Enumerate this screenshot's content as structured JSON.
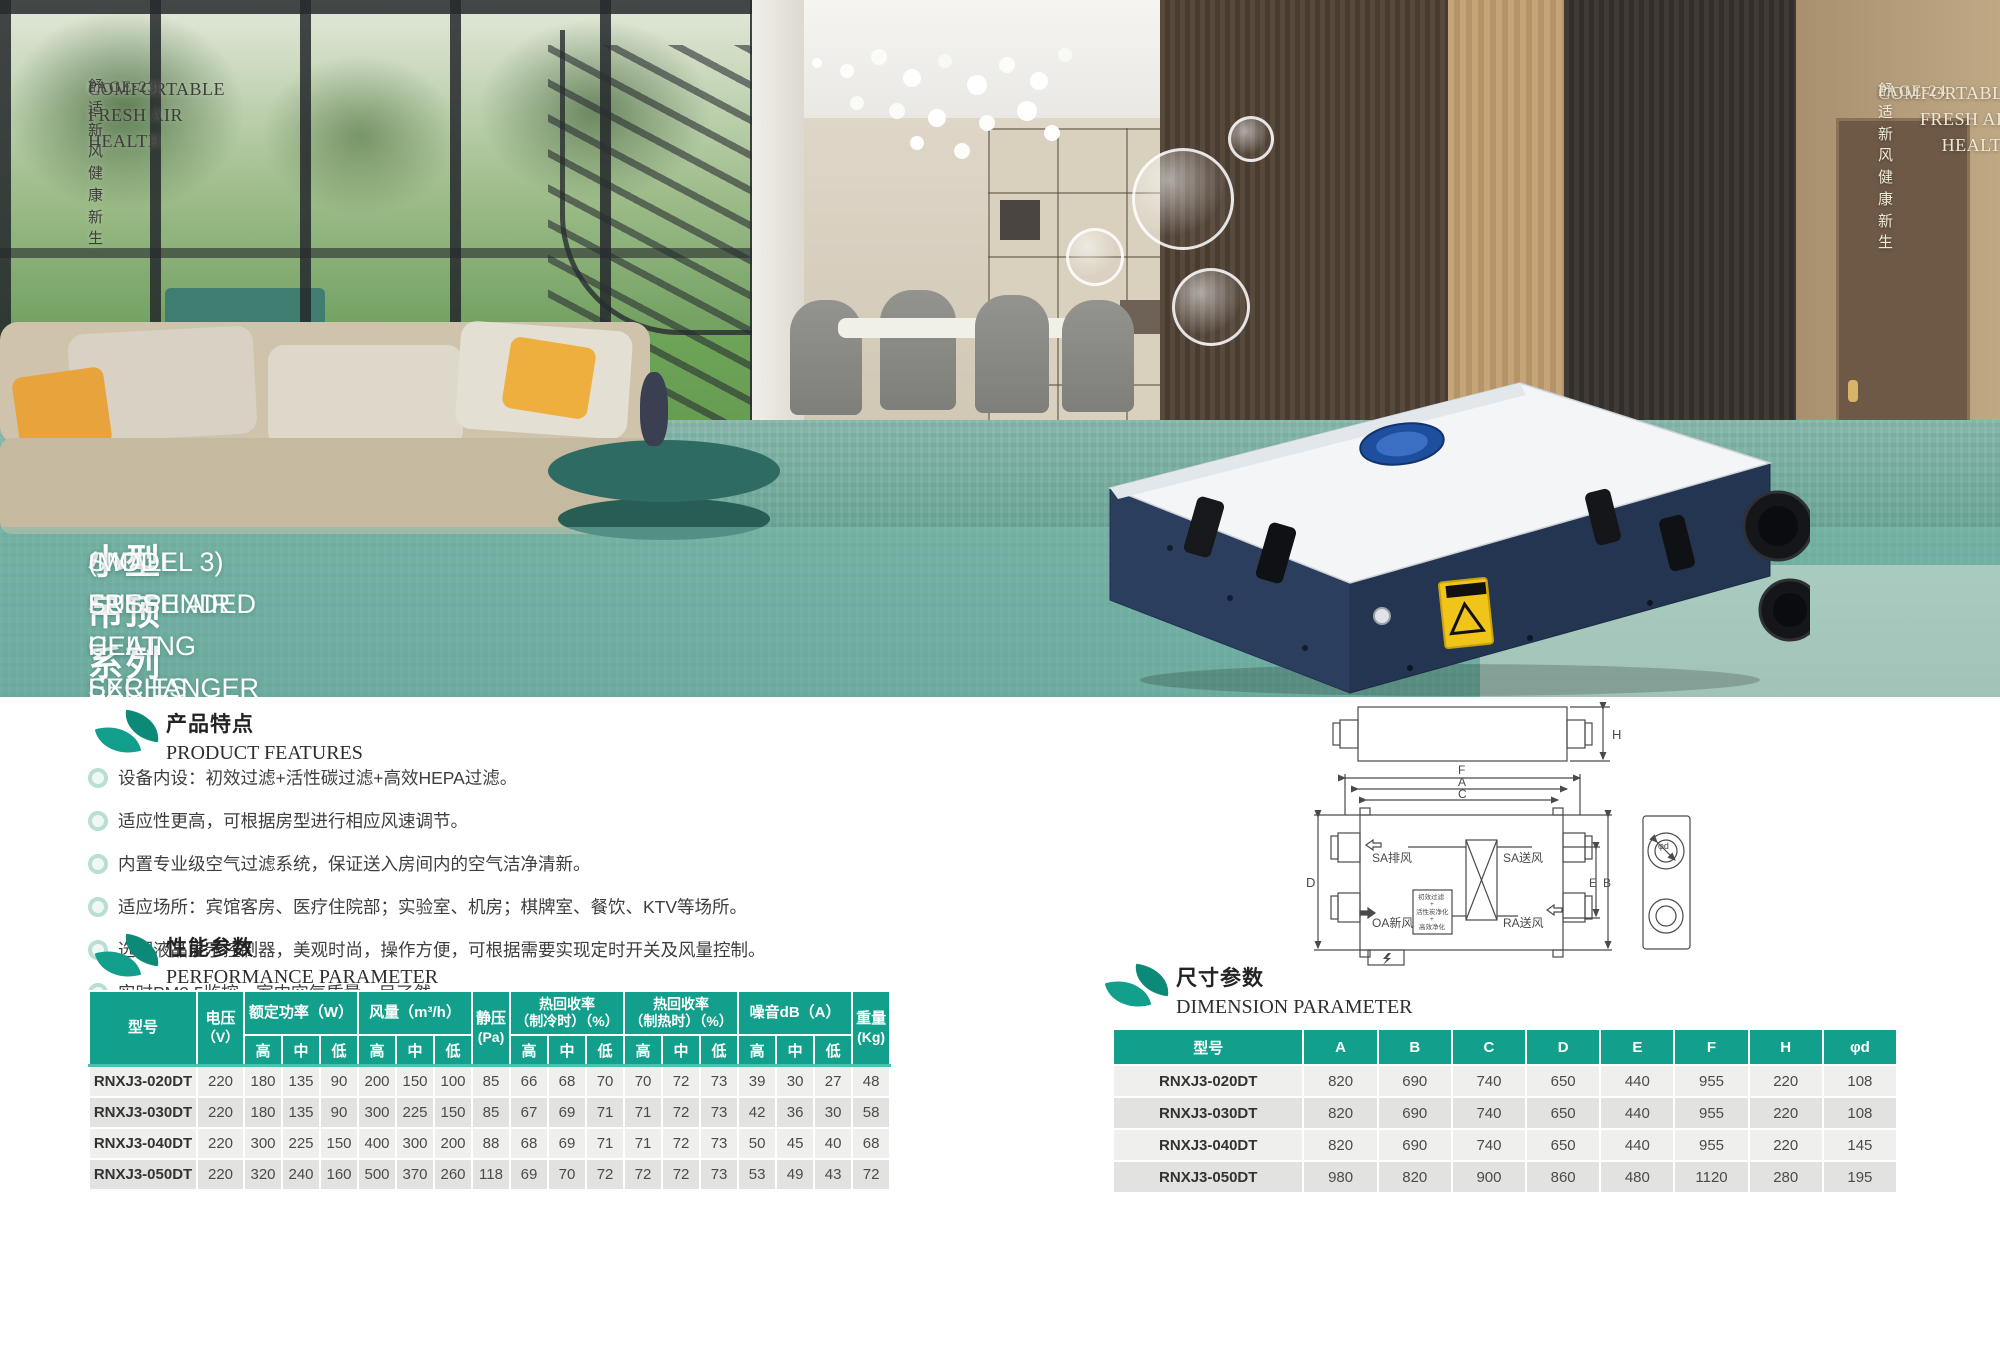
{
  "header_left": {
    "title": "COMFORTABLE FRESH AIR HEALTH",
    "subtitle": "舒适新风 健康新生",
    "page": "PAGE·23"
  },
  "header_right": {
    "title": "COMFORTABLE FRESH AIR HEALTH",
    "subtitle": "舒适新风 健康新生",
    "page": "PAGE·24"
  },
  "hero": {
    "title_cn": "小型吊顶系列（三型）新风全热交换器",
    "title_en_line1": "SMALL SUSPENDED CEILING SERIES",
    "title_en_line2": "(MODEL 3) FRESH AIR HEAT EXCHANGER"
  },
  "features": {
    "heading_cn": "产品特点",
    "heading_en": "PRODUCT FEATURES",
    "items": [
      "设备内设：初效过滤+活性碳过滤+高效HEPA过滤。",
      "适应性更高，可根据房型进行相应风速调节。",
      "内置专业级空气过滤系统，保证送入房间内的空气洁净清新。",
      "适应场所：宾馆客房、医疗住院部；实验室、机房；棋牌室、餐饮、KTV等场所。",
      "选配液晶显示控制器，美观时尚，操作方便，可根据需要实现定时开关及风量控制。",
      "实时PM2.5监控，室内空气质量一目了然。"
    ]
  },
  "performance": {
    "heading_cn": "性能参数",
    "heading_en": "PERFORMANCE PARAMETER",
    "header": {
      "model": "型号",
      "voltage_l1": "电压",
      "voltage_l2": "（V）",
      "power": "额定功率（W）",
      "airflow": "风量（m³/h）",
      "static_l1": "静压",
      "static_l2": "(Pa)",
      "recovery_cool_l1": "热回收率",
      "recovery_cool_l2": "（制冷时）（%）",
      "recovery_heat_l1": "热回收率",
      "recovery_heat_l2": "（制热时）（%）",
      "noise": "噪音dB（A）",
      "weight_l1": "重量",
      "weight_l2": "(Kg)",
      "high": "高",
      "mid": "中",
      "low": "低"
    },
    "rows": [
      [
        "RNXJ3-020DT",
        "220",
        "180",
        "135",
        "90",
        "200",
        "150",
        "100",
        "85",
        "66",
        "68",
        "70",
        "70",
        "72",
        "73",
        "39",
        "30",
        "27",
        "48"
      ],
      [
        "RNXJ3-030DT",
        "220",
        "180",
        "135",
        "90",
        "300",
        "225",
        "150",
        "85",
        "67",
        "69",
        "71",
        "71",
        "72",
        "73",
        "42",
        "36",
        "30",
        "58"
      ],
      [
        "RNXJ3-040DT",
        "220",
        "300",
        "225",
        "150",
        "400",
        "300",
        "200",
        "88",
        "68",
        "69",
        "71",
        "71",
        "72",
        "73",
        "50",
        "45",
        "40",
        "68"
      ],
      [
        "RNXJ3-050DT",
        "220",
        "320",
        "240",
        "160",
        "500",
        "370",
        "260",
        "118",
        "69",
        "70",
        "72",
        "72",
        "72",
        "73",
        "53",
        "49",
        "43",
        "72"
      ]
    ]
  },
  "dimension": {
    "heading_cn": "尺寸参数",
    "heading_en": "DIMENSION PARAMETER",
    "columns": [
      "型号",
      "A",
      "B",
      "C",
      "D",
      "E",
      "F",
      "H",
      "φd"
    ],
    "rows": [
      [
        "RNXJ3-020DT",
        "820",
        "690",
        "740",
        "650",
        "440",
        "955",
        "220",
        "108"
      ],
      [
        "RNXJ3-030DT",
        "820",
        "690",
        "740",
        "650",
        "440",
        "955",
        "220",
        "108"
      ],
      [
        "RNXJ3-040DT",
        "820",
        "690",
        "740",
        "650",
        "440",
        "955",
        "220",
        "145"
      ],
      [
        "RNXJ3-050DT",
        "980",
        "820",
        "900",
        "860",
        "480",
        "1120",
        "280",
        "195"
      ]
    ]
  },
  "diagram": {
    "dim_h": "H",
    "dim_f": "F",
    "dim_a": "A",
    "dim_c": "C",
    "dim_d": "D",
    "dim_e": "E",
    "dim_b": "B",
    "dim_phid": "φd",
    "label_sa_exhaust": "SA排风",
    "label_sa_supply": "SA送风",
    "label_oa_fresh": "OA新风",
    "label_ra_return": "RA送风",
    "filter_line1": "初效过滤",
    "filter_plus1": "+",
    "filter_line2": "活性炭净化",
    "filter_plus2": "+",
    "filter_line3": "高效净化"
  },
  "colors": {
    "accent_teal": "#12a08c",
    "leaf_dark": "#0d8a77",
    "overlay_teal": "rgba(125,190,177,0.52)",
    "unit_body_blue": "#2c3e5d",
    "warning_yellow": "#f0c419"
  }
}
